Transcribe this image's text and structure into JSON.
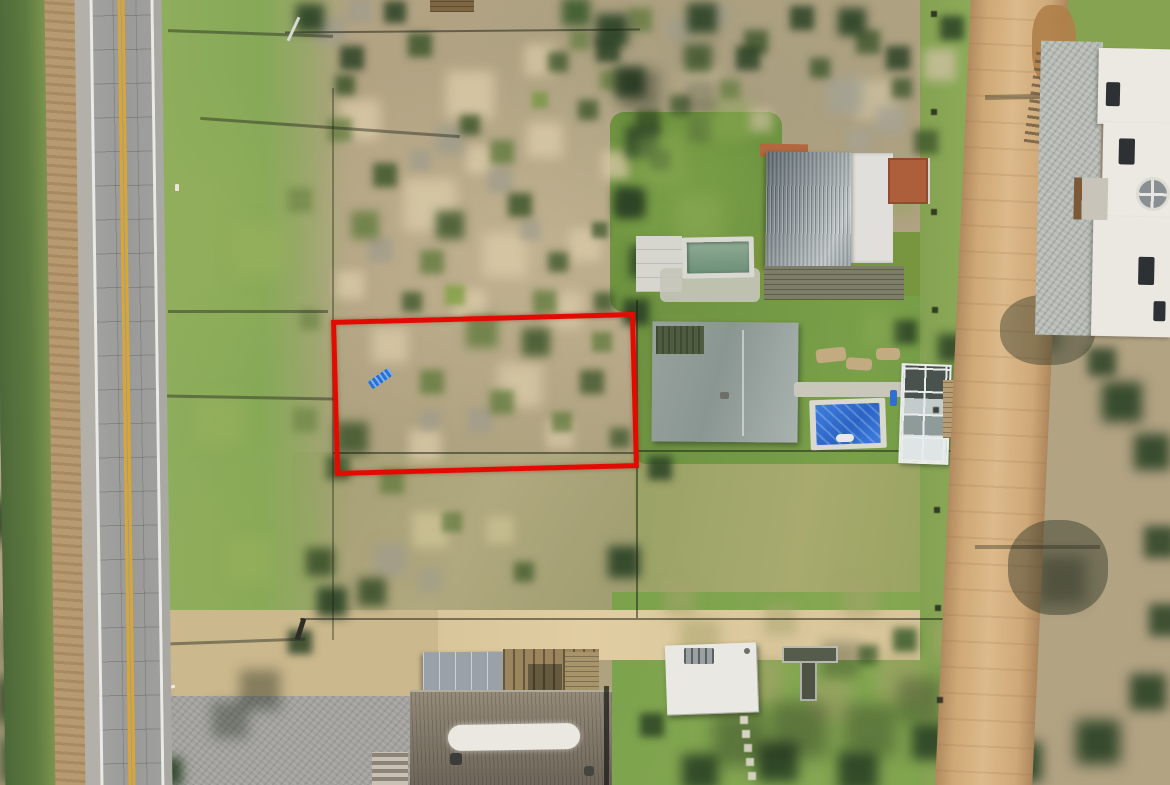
{
  "meta": {
    "type": "aerial-drone-photograph",
    "description": "Top-down drone photo of a vacant coastal scrubland lot outlined in red, flanked by a paved highway on the left, a sandy dirt road on the right, and neighbouring houses with pools, decks and gardens.",
    "visible_text": "none"
  },
  "labels": {
    "scene": "Aerial view of property with red boundary overlay",
    "paved_road": "Paved two-lane road with double yellow centerline",
    "grass_verge": "Mown grass verge beside road",
    "vacant_plot": "Vacant scrubland dune lot",
    "red_outline": "Red plot boundary highlight",
    "blue_object": "Small blue object inside plot",
    "corrugated_house": "House with corrugated metal roof",
    "lap_pool": "Narrow lap pool with green water",
    "hip_roof_house": "House with grey hip roof",
    "covered_pool": "Swimming pool with blue cover",
    "greenhouse": "Glass greenhouse",
    "wood_deck": "Timber deck platform",
    "dirt_road": "Sandy dirt road",
    "white_villa": "White villa with gravel courtyard",
    "round_window": "Round window with cross muntins",
    "thatched_house": "House with thatched roof and white ridge cap",
    "carport": "Flat grey carport roof",
    "pergola": "Timber pergola",
    "white_shed": "Small white-roofed shed",
    "stepping_path": "Stepping-stone path",
    "planters": "Raised garden planters",
    "sand_band": "Sandy track along fence line",
    "gravel_driveway": "Gravel driveway",
    "fence": "Wire boundary fence",
    "pole_shadow": "Utility pole shadow",
    "tree_canopy": "Tree canopy",
    "shrubs": "Dune shrubs and grasses"
  },
  "palette": {
    "asphalt": "#9c9c9a",
    "center_line_yellow": "#d8a637",
    "edge_line_white": "#e9e9e6",
    "grass_verge_green": "#86a957",
    "scrub_sand": "#b2a383",
    "shrub_green": "#3e5a2c",
    "plot_outline_red": "#e30b00",
    "pool_cover_blue": "#2a63c4",
    "lap_pool_water": "#7d9c85",
    "dirt_road_tan": "#cfa876",
    "corrugated_roof_grey": "#8d979b",
    "hip_roof_grey": "#97a29e",
    "white_roof": "#e9e8e2",
    "terracotta_terrace": "#ad5e3a",
    "thatch_roof": "#837a6b",
    "villa_white": "#ebe9e2"
  }
}
